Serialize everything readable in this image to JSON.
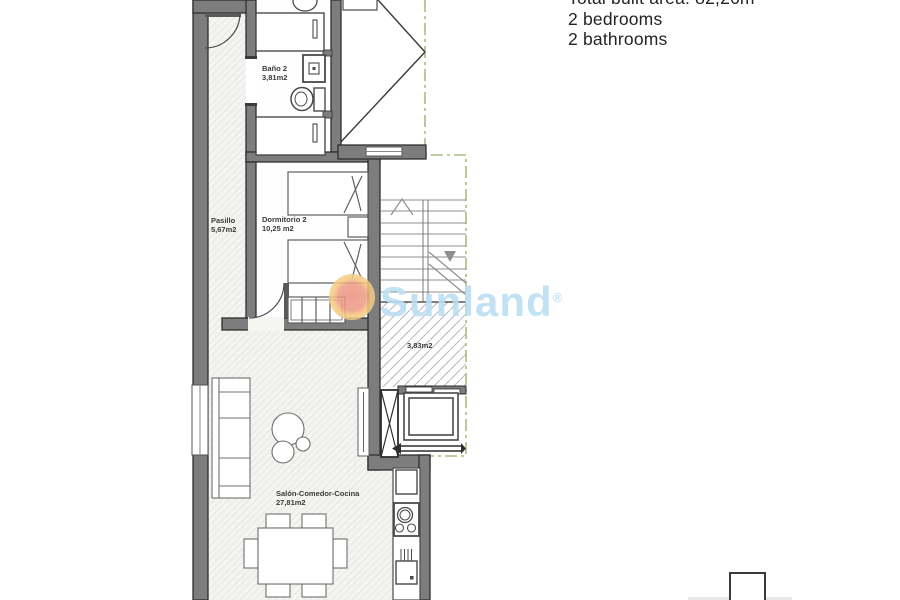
{
  "info_panel": {
    "lines": [
      "Total built area: 82,26m²",
      "2 bedrooms",
      "2 bathrooms"
    ]
  },
  "watermark": {
    "brand": "Sunland",
    "registered_mark": "®",
    "text_color": "#bcdef2",
    "sun_inner_color": "#ee8f7d",
    "sun_outer_color": "#f6c97f"
  },
  "floor_plan": {
    "rooms": [
      {
        "id": "bano2",
        "name": "Baño 2",
        "area": "3,81m2"
      },
      {
        "id": "pasillo",
        "name": "Pasillo",
        "area": "5,67m2"
      },
      {
        "id": "dormitorio2",
        "name": "Dormitorio 2",
        "area": "10,25 m2"
      },
      {
        "id": "terraza",
        "area": "3,83m2"
      },
      {
        "id": "salon",
        "name": "Salón-Comedor-Cocina",
        "area": "27,81m2"
      }
    ],
    "colors": {
      "wall_fill": "#7d7d7d",
      "wall_outline": "#2f2f2f",
      "boundary_green": "#a7bd82",
      "floor_tint": "#f6f6f4",
      "label_color": "#3b3b3b"
    }
  }
}
